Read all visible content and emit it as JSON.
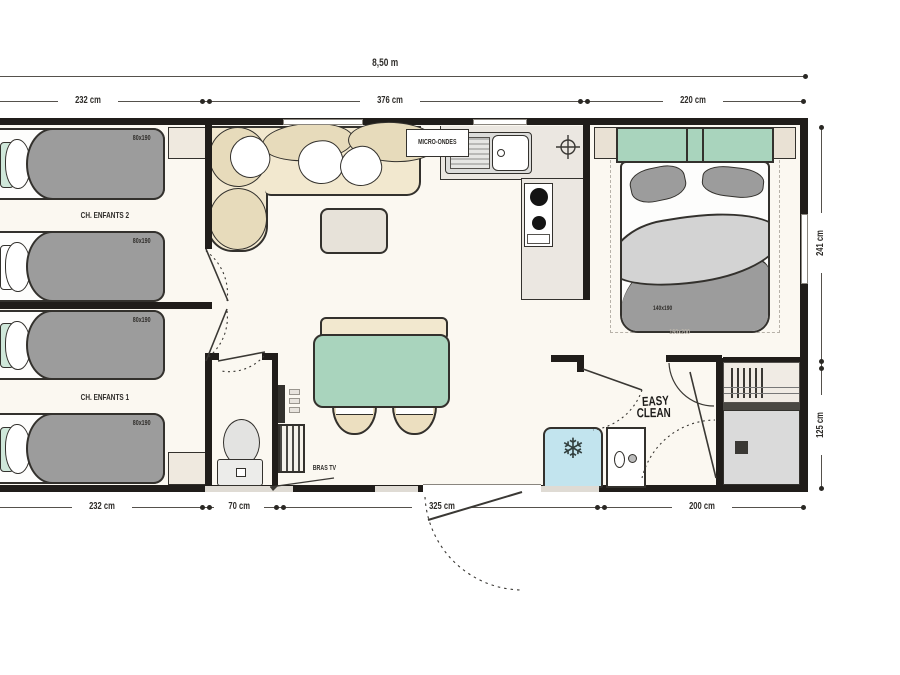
{
  "dimensions": {
    "overall": "8,50 m",
    "top": [
      "232 cm",
      "376 cm",
      "220 cm"
    ],
    "right": [
      "241 cm",
      "125 cm"
    ],
    "bottom": [
      "232 cm",
      "70 cm",
      "325 cm",
      "200 cm"
    ]
  },
  "rooms": {
    "kids_room_2_label": "CH. ENFANTS 2",
    "kids_room_1_label": "CH. ENFANTS 1"
  },
  "beds": {
    "single_sizes": [
      "80x190",
      "80x190",
      "80x190",
      "80x190"
    ],
    "double_size": "140x190",
    "double_footprint": "160x200"
  },
  "kitchen": {
    "microwave_label": "MICRO-ONDES"
  },
  "living": {
    "tv_bracket_label": "BRAS TV"
  },
  "bathroom": {
    "brand_line1": "EASY",
    "brand_line2": "CLEAN"
  },
  "icons": {
    "snowflake": "❄"
  },
  "colors": {
    "wall": "#201d1a",
    "floor": "#fbf8f1",
    "furniture_gray": "#9c9c9c",
    "green": "#a9d4bd",
    "beige": "#f2e8cf",
    "cushion": "#e7dbbb",
    "counter": "#ebe7e1",
    "fridge_blue": "#c2e4ee",
    "shower_gray": "#dadada",
    "dim_text": "#2e2c29"
  }
}
